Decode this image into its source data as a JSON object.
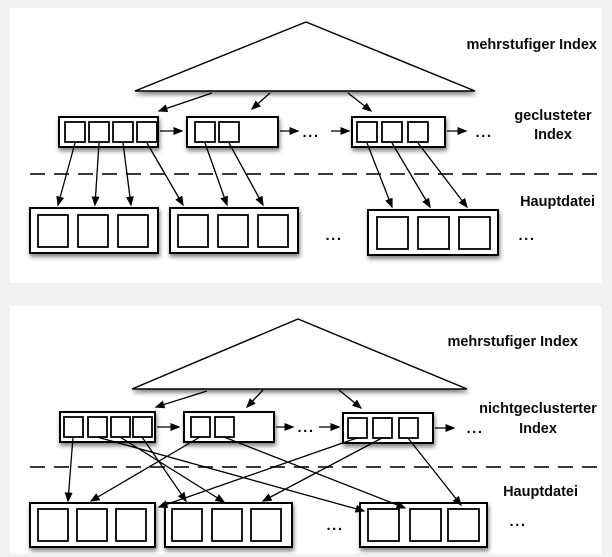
{
  "colors": {
    "background": "#f1f1f2",
    "panel": "#ffffff",
    "ink": "#000000"
  },
  "diagrams": {
    "top": {
      "level_label": "mehrstufiger Index",
      "index_label_line1": "geclusteter",
      "index_label_line2": "Index",
      "file_label": "Hauptdatei",
      "ellipsis": "...",
      "structure": {
        "index_blocks": [
          {
            "entries": 4
          },
          {
            "entries": 2
          },
          {
            "entries": 3
          }
        ],
        "file_blocks": [
          {
            "records": 3
          },
          {
            "records": 3
          },
          {
            "records": 3
          }
        ],
        "entry_to_record_arrows": [
          "b1.e1 -> f1.r1",
          "b1.e2 -> f1.r2",
          "b1.e3 -> f1.r3",
          "b1.e4 -> f2.r1",
          "b2.e1 -> f2.r2",
          "b2.e2 -> f2.r3",
          "b3.e1 -> f3.r1",
          "b3.e2 -> f3.r2",
          "b3.e3 -> f3.r3"
        ]
      }
    },
    "bottom": {
      "level_label": "mehrstufiger Index",
      "index_label_line1": "nichtgeclusterter",
      "index_label_line2": "Index",
      "file_label": "Hauptdatei",
      "ellipsis": "...",
      "structure": {
        "index_blocks": [
          {
            "entries": 4
          },
          {
            "entries": 2
          },
          {
            "entries": 3
          }
        ],
        "file_blocks": [
          {
            "records": 3
          },
          {
            "records": 3
          },
          {
            "records": 3
          }
        ],
        "entry_to_record_arrows": [
          "b1.e1 -> f1.r1",
          "b1.e2 -> f3.r1",
          "b1.e3 -> f2.r2",
          "b1.e4 -> f2.r1",
          "b2.e1 -> f1.r2",
          "b2.e2 -> f3.r2",
          "b3.e1 -> f1.r3",
          "b3.e2 -> f2.r3",
          "b3.e3 -> f3.r3"
        ]
      }
    }
  }
}
